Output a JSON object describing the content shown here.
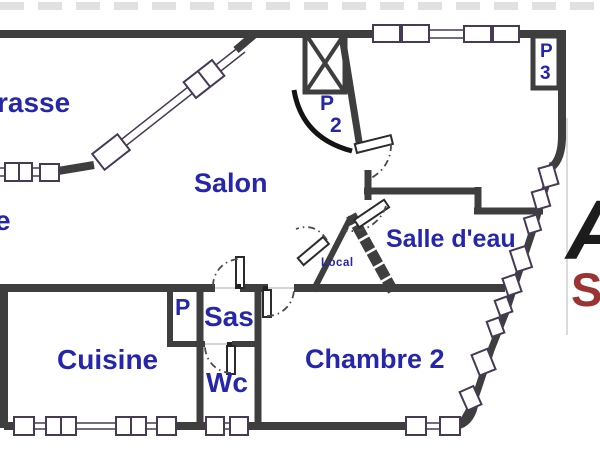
{
  "colors": {
    "wall": "#3e3e3e",
    "window-outline": "#463a55",
    "label-blue": "#2626ad",
    "logo-red": "#9c3333",
    "logo-black": "#1c1c1c"
  },
  "labels": {
    "terrasse_partial": "rasse",
    "left_edge_partial": "e",
    "salon": "Salon",
    "door_p2_letter": "P",
    "door_p2_number": "2",
    "door_p3_letter": "P",
    "door_p3_number": "3",
    "salle_deau": "Salle d'eau",
    "local": "Local",
    "closet_p": "P",
    "sas": "Sas",
    "cuisine": "Cuisine",
    "wc": "Wc",
    "chambre2": "Chambre 2",
    "watermark_a": "A",
    "watermark_s": "S"
  }
}
